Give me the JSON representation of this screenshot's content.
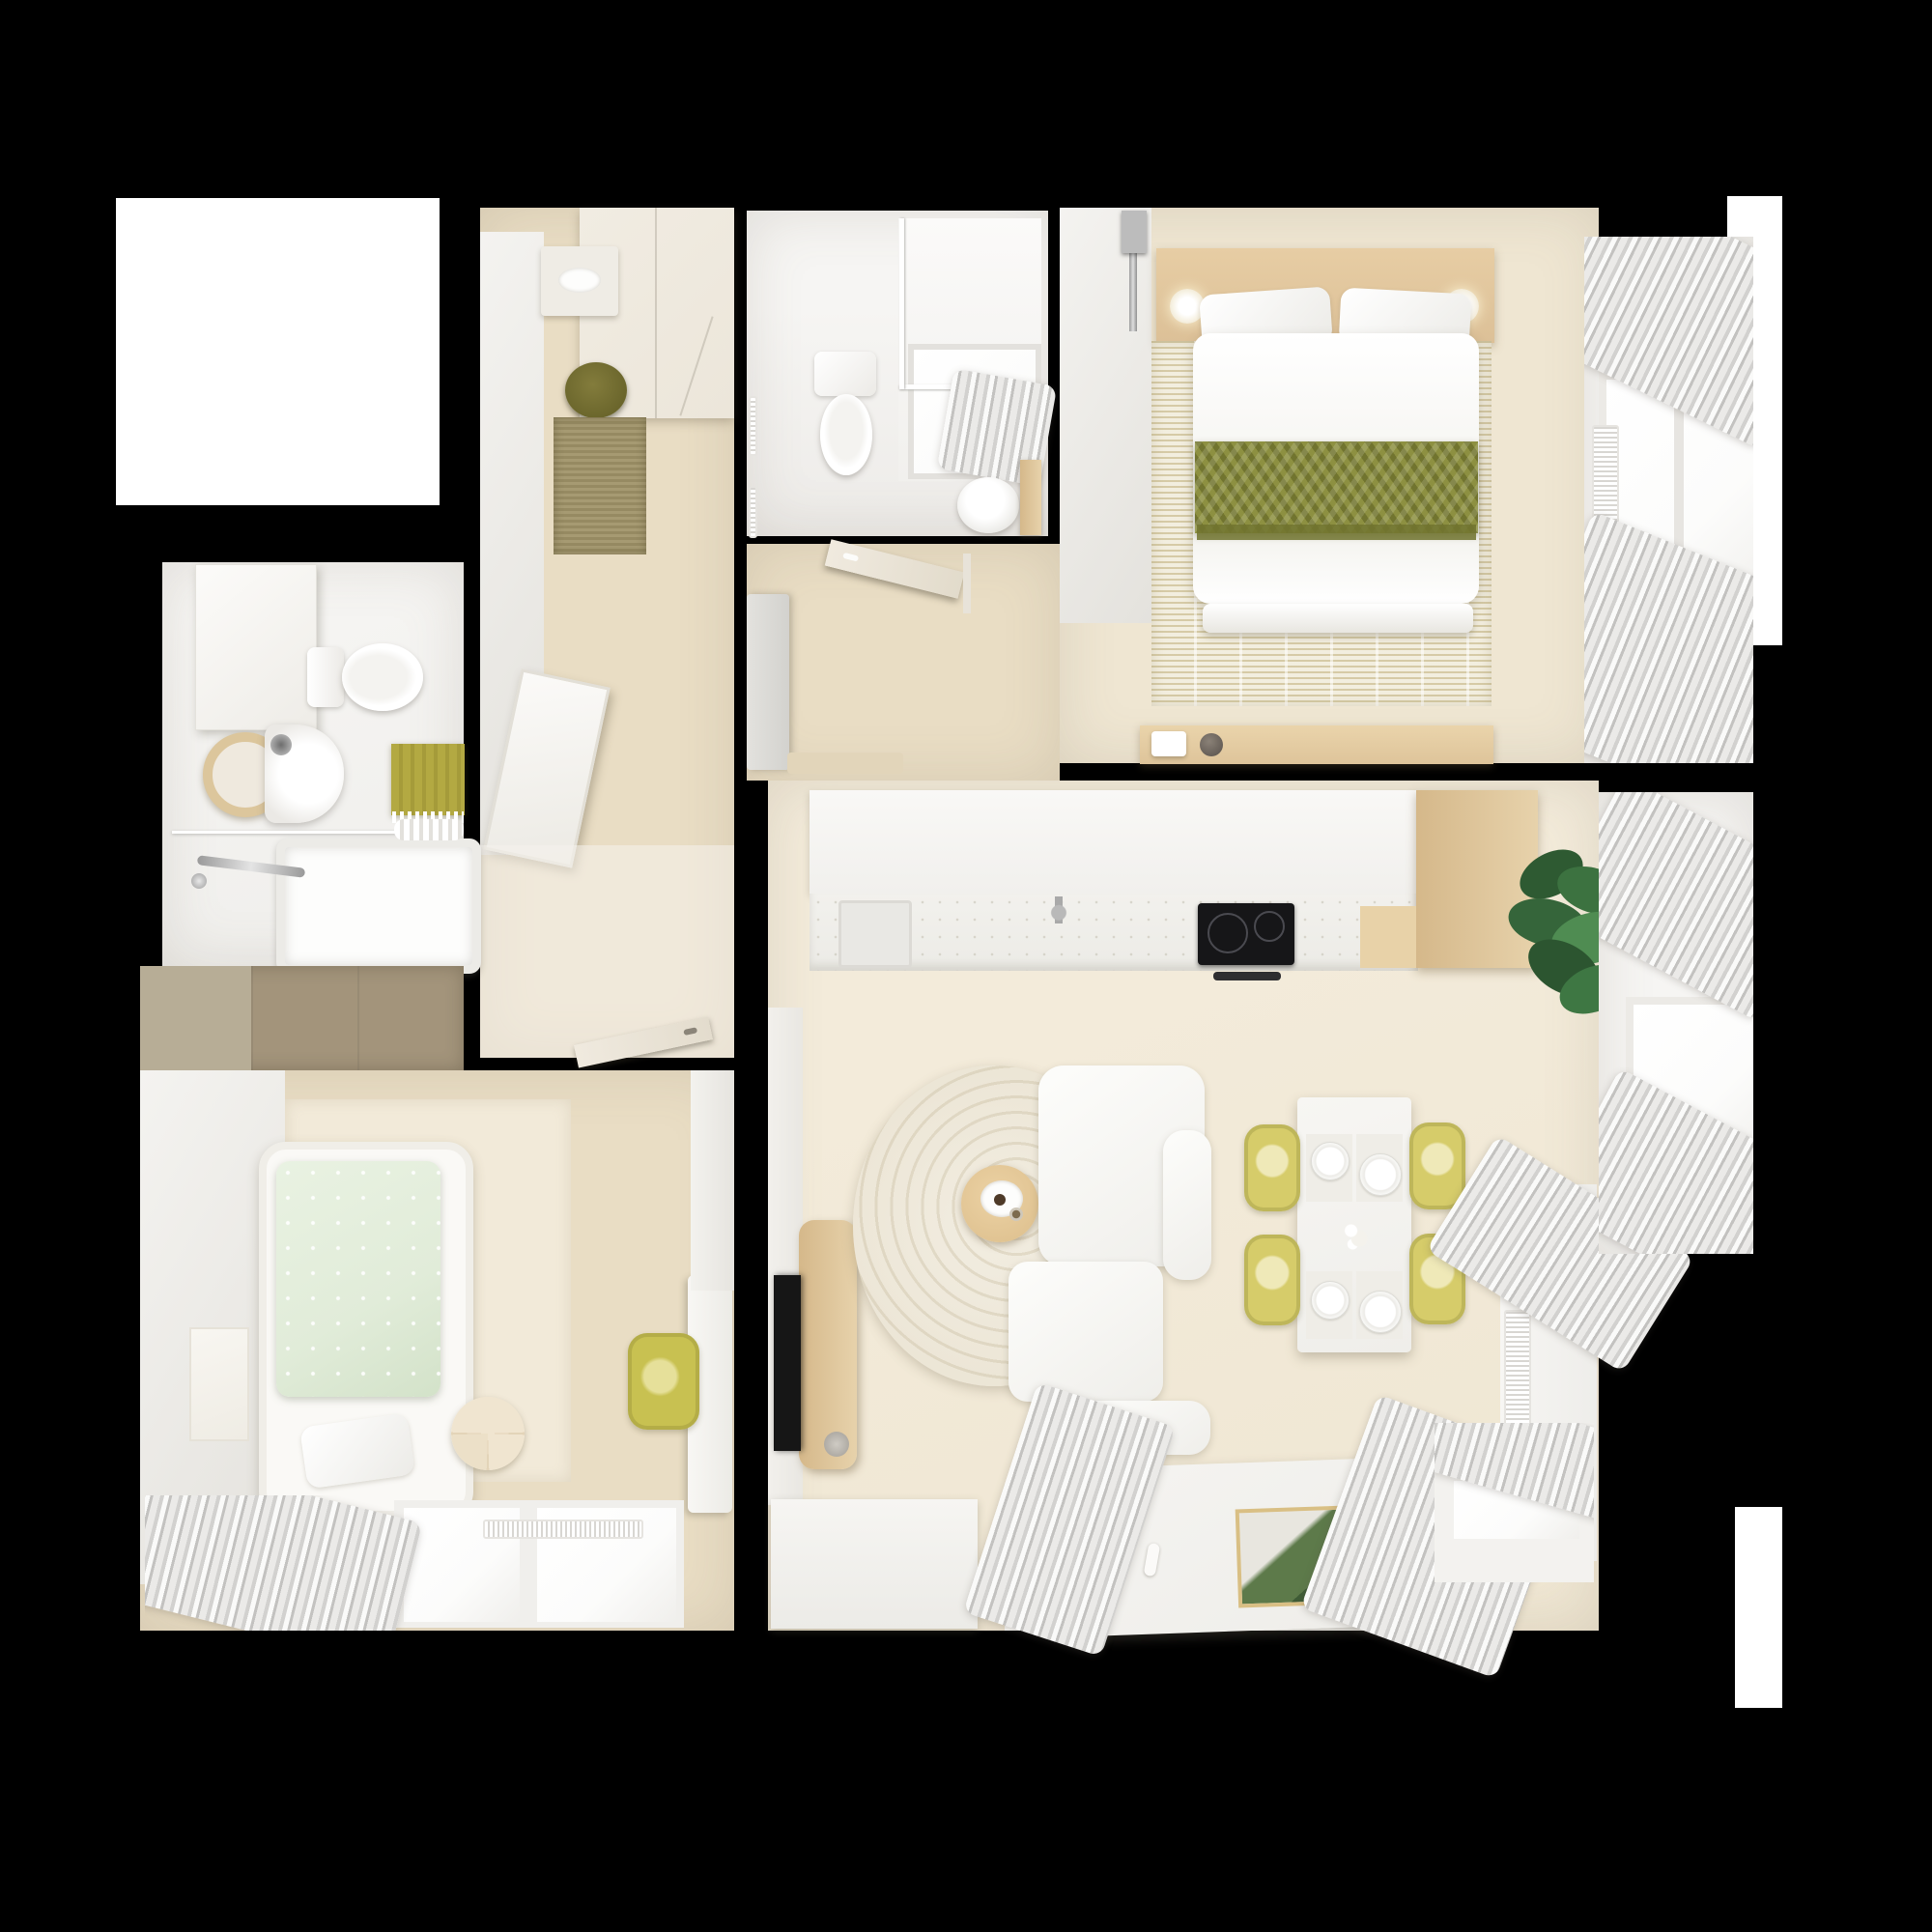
{
  "meta": {
    "title": "Top-down 3D apartment floor plan render",
    "view": "overhead dollhouse view",
    "background": "black"
  },
  "palette": {
    "background": "#000000",
    "floor_wood": "#e9ddc4",
    "floor_wood_light": "#efe6d2",
    "wall_white": "#f4f3f0",
    "wall_shadow": "#e4e2dd",
    "cream_cabinet": "#ece6da",
    "jute_rug": "#a69a72",
    "olive_basket": "#6b662c",
    "taupe_wardrobe": "#a3947b",
    "taupe_wardrobe_light": "#b7ad96",
    "wood_headboard": "#dcc097",
    "wood_bar": "#d5b88a",
    "olive_throw": "#8d9041",
    "olive_throw_dark": "#71742f",
    "bedroom_rug": "#e6ddbf",
    "mint_blanket": "#e1ecd9",
    "pale_rug": "#f2ead9",
    "yellow_chair": "#d6cc6a",
    "yellow_desk_chair": "#c8c151",
    "green_towel": "#b3a942",
    "plant_green": "#2e5a32",
    "plant_green_light": "#4f8c52",
    "tile_gray": "#edebe8",
    "glass_white": "#fcfcfb",
    "appliance_black": "#161618"
  },
  "rooms": [
    {
      "id": "entry-hall",
      "name": "Entry hall",
      "furniture": [
        "wardrobe",
        "wall shelf with tray",
        "storage basket",
        "jute rug",
        "leaning mirror",
        "interior door"
      ]
    },
    {
      "id": "bathroom-small",
      "name": "Guest bathroom",
      "furniture": [
        "toilet",
        "shower tray with curtain",
        "pedestal sink",
        "wooden shelf",
        "towel rails"
      ]
    },
    {
      "id": "corridor",
      "name": "Inner corridor",
      "furniture": [
        "tall gray cabinet",
        "bench",
        "door to bedroom"
      ]
    },
    {
      "id": "bedroom-master",
      "name": "Master bedroom",
      "furniture": [
        "double bed",
        "wood headboard shelf",
        "two sconce lamps",
        "olive herringbone throw",
        "textured area rug",
        "bedside console",
        "sliding door track",
        "bay window with bunched curtains",
        "radiator"
      ]
    },
    {
      "id": "bathroom-main",
      "name": "Main bathroom",
      "furniture": [
        "wall cabinet",
        "toilet",
        "vessel sink",
        "round wood mirror",
        "bathtub with chrome faucet",
        "green towel",
        "white towels",
        "glass screen"
      ]
    },
    {
      "id": "kids-room",
      "name": "Second bedroom",
      "furniture": [
        "taupe wardrobe",
        "single bed with mint duvet",
        "pillow",
        "round side table",
        "wall art",
        "desk",
        "yellow desk chair",
        "window with curtains",
        "radiator"
      ]
    },
    {
      "id": "kitchen",
      "name": "Kitchen",
      "furniture": [
        "upper cabinet run",
        "counter with sink",
        "chrome faucet",
        "induction hob",
        "oven handle",
        "wood bar peninsula",
        "potted plant"
      ]
    },
    {
      "id": "living-room",
      "name": "Living / dining room",
      "furniture": [
        "white corner sofa",
        "round cream rug",
        "small round wood coffee table",
        "TV panel with TV",
        "speaker",
        "dining table with place settings",
        "four yellow chairs",
        "large white coffee table",
        "art book",
        "window seat with cushion",
        "radiators",
        "bunched striped curtains",
        "credenza"
      ]
    }
  ],
  "structure": {
    "white_blocks": [
      "unrendered room top-left",
      "shaft right top",
      "shaft right bottom"
    ],
    "walls": "thick black between rooms"
  }
}
